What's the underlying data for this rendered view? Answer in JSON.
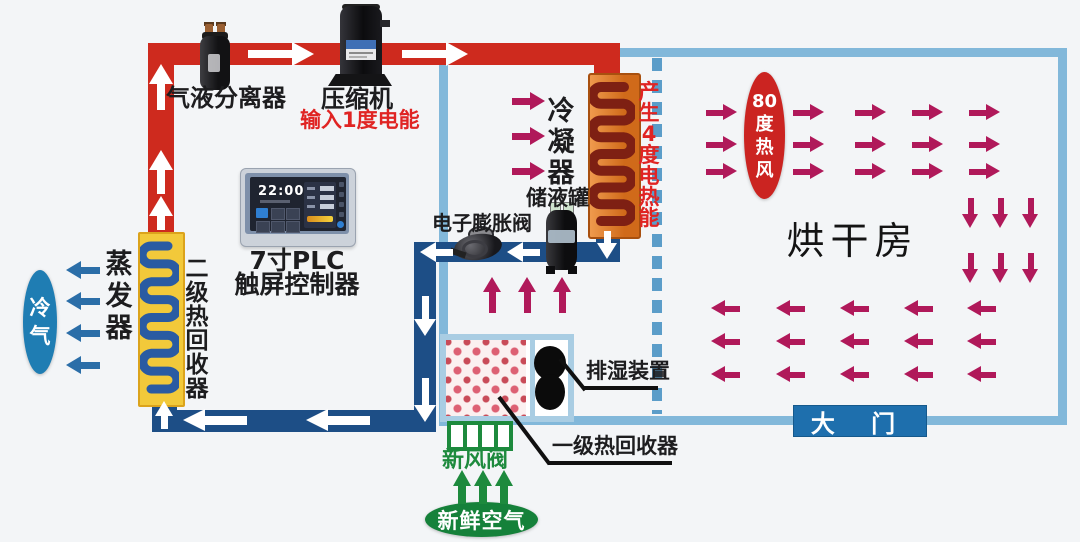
{
  "labels": {
    "gas_liquid_separator": "气液分离器",
    "compressor": "压缩机",
    "power_input": "输入1度电能",
    "plc_title": "7寸PLC",
    "plc_subtitle": "触屏控制器",
    "condenser": "冷凝器",
    "heat_gain": "产生4度电热能",
    "receiver_tank": "储液罐",
    "expansion_valve": "电子膨胀阀",
    "hot_air_80": "80度热风",
    "drying_room": "烘干房",
    "door": "大 门",
    "dehumidifier": "排湿装置",
    "primary_heat_recovery": "一级热回收器",
    "fresh_air_valve": "新风阀",
    "fresh_air": "新鲜空气",
    "cold_air": "冷气",
    "evaporator": "蒸发器",
    "secondary_heat_recovery": "二级热回收器"
  },
  "plc": {
    "time": "22:00"
  },
  "colors": {
    "hot_pipe": "#ce2a1e",
    "cold_pipe": "#1d4e86",
    "wall": "#82b8da",
    "dashed_wall": "#5b9dc9",
    "airflow_arrow": "#b0195a",
    "cold_air_arrow": "#2b6ea8",
    "fresh_green": "#1d8a3d",
    "hot_air_ellipse": "#cb2421",
    "cold_air_ellipse": "#1f7db3",
    "fresh_air_ellipse": "#15813a",
    "door_bg": "#1e6fad",
    "condenser_body": "#d2691e",
    "condenser_coil": "#7e2013",
    "evaporator_body": "#f2c93a",
    "evaporator_coil": "#2a5ba2",
    "red_text": "#e02423",
    "white_arrow": "#ffffff"
  }
}
